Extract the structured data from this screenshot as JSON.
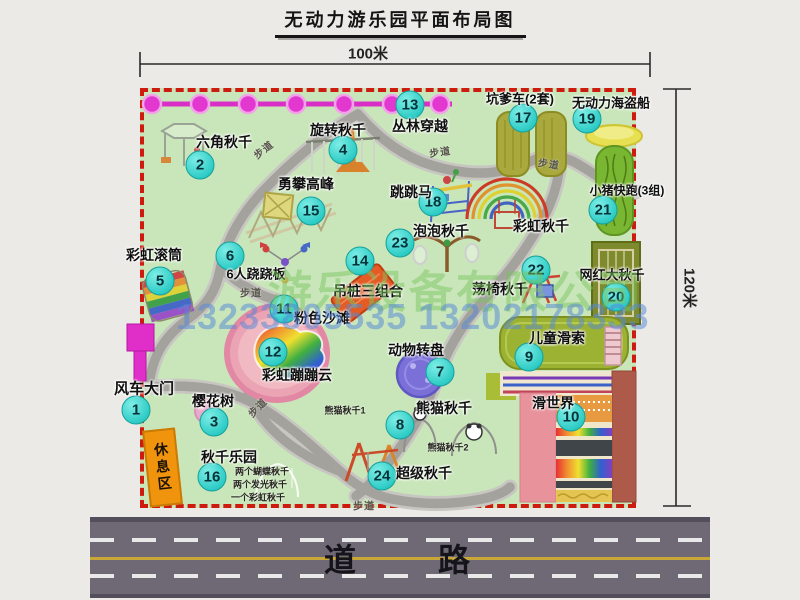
{
  "title": "无动力游乐园平面布局图",
  "dimensions": {
    "width_label": "100米",
    "height_label": "120米"
  },
  "road_label": "道　　路",
  "rest_area_label": "休息区",
  "path_label": "步道",
  "watermark": {
    "company": "游乐设备有限公司",
    "phone": "13233805535 13202178333"
  },
  "colors": {
    "map_green": "#c9e6ba",
    "border_red": "#ce1b10",
    "badge_cyan": "#2fccc6",
    "zipline_magenta": "#da2fc6",
    "road_gray": "#6e6975",
    "rest_orange": "#f1940d"
  },
  "attractions": [
    {
      "num": "1",
      "name": "风车大门",
      "lx": 144,
      "ly": 388,
      "bx": 136,
      "by": 410,
      "fs": 15
    },
    {
      "num": "2",
      "name": "六角秋千",
      "lx": 224,
      "ly": 142,
      "bx": 200,
      "by": 165
    },
    {
      "num": "3",
      "name": "樱花树",
      "lx": 213,
      "ly": 401,
      "bx": 214,
      "by": 422
    },
    {
      "num": "4",
      "name": "旋转秋千",
      "lx": 338,
      "ly": 130,
      "bx": 343,
      "by": 150
    },
    {
      "num": "5",
      "name": "彩虹滚筒",
      "lx": 154,
      "ly": 255,
      "bx": 160,
      "by": 281
    },
    {
      "num": "6",
      "name": "6人跷跷板",
      "lx": 256,
      "ly": 273,
      "bx": 230,
      "by": 256,
      "fs": 13
    },
    {
      "num": "7",
      "name": "动物转盘",
      "lx": 416,
      "ly": 350,
      "bx": 440,
      "by": 372
    },
    {
      "num": "8",
      "name": "熊猫秋千",
      "lx": 444,
      "ly": 408,
      "bx": 400,
      "by": 425
    },
    {
      "num": "9",
      "name": "儿童滑索",
      "lx": 557,
      "ly": 338,
      "bx": 529,
      "by": 357
    },
    {
      "num": "10",
      "name": "滑世界",
      "lx": 553,
      "ly": 403,
      "bx": 571,
      "by": 417
    },
    {
      "num": "11",
      "name": "粉色沙滩",
      "lx": 322,
      "ly": 318,
      "bx": 284,
      "by": 309
    },
    {
      "num": "12",
      "name": "彩虹蹦蹦云",
      "lx": 297,
      "ly": 375,
      "bx": 273,
      "by": 352
    },
    {
      "num": "13",
      "name": "丛林穿越",
      "lx": 420,
      "ly": 126,
      "bx": 410,
      "by": 105
    },
    {
      "num": "14",
      "name": "吊桩三组合",
      "lx": 368,
      "ly": 291,
      "bx": 360,
      "by": 261
    },
    {
      "num": "15",
      "name": "勇攀高峰",
      "lx": 306,
      "ly": 184,
      "bx": 311,
      "by": 211
    },
    {
      "num": "16",
      "name": "秋千乐园",
      "lx": 229,
      "ly": 457,
      "bx": 212,
      "by": 477
    },
    {
      "num": "17",
      "name": "坑爹车(2套)",
      "lx": 520,
      "ly": 98,
      "bx": 523,
      "by": 118,
      "fs": 13
    },
    {
      "num": "18",
      "name": "跳跳马",
      "lx": 411,
      "ly": 192,
      "bx": 433,
      "by": 202
    },
    {
      "num": "19",
      "name": "无动力海盗船",
      "lx": 611,
      "ly": 102,
      "bx": 587,
      "by": 119,
      "fs": 13
    },
    {
      "num": "20",
      "name": "网红大秋千",
      "lx": 612,
      "ly": 274,
      "bx": 616,
      "by": 297,
      "fs": 13
    },
    {
      "num": "21",
      "name": "小猪快跑(3组)",
      "lx": 627,
      "ly": 190,
      "bx": 603,
      "by": 210,
      "fs": 12
    },
    {
      "num": "22",
      "name": "荡椅秋千",
      "lx": 500,
      "ly": 289,
      "bx": 536,
      "by": 270
    },
    {
      "num": "23",
      "name": "泡泡秋千",
      "lx": 441,
      "ly": 231,
      "bx": 400,
      "by": 243
    },
    {
      "num": "24",
      "name": "超级秋千",
      "lx": 424,
      "ly": 473,
      "bx": 382,
      "by": 476
    },
    {
      "num": "",
      "name": "彩虹秋千",
      "lx": 541,
      "ly": 226
    }
  ],
  "sub_labels": [
    {
      "text": "熊猫秋千1",
      "x": 345,
      "y": 410
    },
    {
      "text": "熊猫秋千2",
      "x": 448,
      "y": 447
    },
    {
      "text": "两个蝴蝶秋千",
      "x": 262,
      "y": 471
    },
    {
      "text": "两个发光秋千",
      "x": 260,
      "y": 484
    },
    {
      "text": "一个彩虹秋千",
      "x": 258,
      "y": 497
    }
  ],
  "trail_labels": [
    {
      "x": 263,
      "y": 149,
      "rot": -38
    },
    {
      "x": 440,
      "y": 151,
      "rot": -8
    },
    {
      "x": 549,
      "y": 163,
      "rot": 8
    },
    {
      "x": 251,
      "y": 292,
      "rot": 0
    },
    {
      "x": 257,
      "y": 407,
      "rot": -45
    },
    {
      "x": 364,
      "y": 505,
      "rot": 0
    }
  ]
}
